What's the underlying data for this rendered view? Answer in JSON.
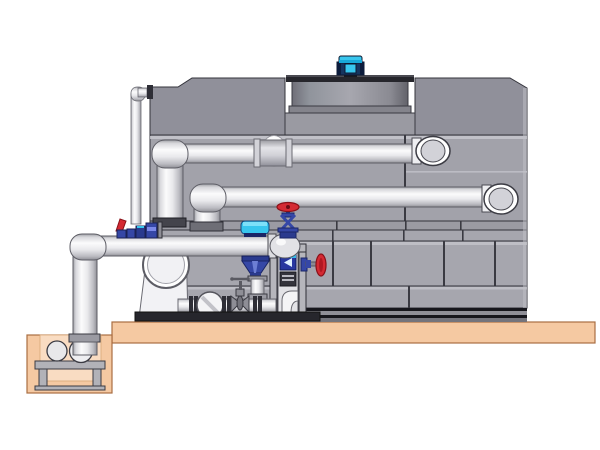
{
  "diagram": {
    "type": "technical-illustration",
    "subject": "Evaporative cooling tower with fan motor, external piping, pump skid and sump pit",
    "components": [
      "cooling-tower-casing",
      "fan-shroud",
      "fan-motor",
      "supply-pipe-upper",
      "return-pipe-middle",
      "header-pipe-lower",
      "makeup-pipe",
      "sump-riser-pipe",
      "sump-pit",
      "sump-pump",
      "pump-stand",
      "circulation-pump",
      "check-valve",
      "gate-valve",
      "control-valve-cyan-actuator",
      "globe-valve-red-handwheel",
      "side-handwheel-valve",
      "lever-valve-red",
      "inline-blue-valve-assembly",
      "instrument-frame-column",
      "flow-indicator",
      "skid-base",
      "concrete-platform"
    ]
  },
  "colors": {
    "platform": "#f5c9a2",
    "platform_edge": "#a96e42",
    "pit_interior": "#f9dcc2",
    "panel": "#a2a2aa",
    "panel_dark": "#90909a",
    "panel_row": "#a6a6ae",
    "panel_thin": "#9b9ba3",
    "panel_light": "#c9c9cf",
    "recess": "#9a9aa2",
    "base_dark": "#16161c",
    "base_gray": "#8f8f97",
    "base_mid": "#74747c",
    "shroud_top": "#26262c",
    "shroud_lip": "#84848c",
    "motor_navy": "#16355f",
    "accent_cyan": "#38c6ee",
    "cyan_dark": "#18a8d8",
    "flange_dark": "#2e2e36",
    "flange_gray": "#9a9aa2",
    "dome": "#d2d2d8",
    "dome_light": "#e2e2e6",
    "ring_white": "#ffffff",
    "valve_navy": "#3547a6",
    "valve_navy_dark": "#2a3a8e",
    "valve_navy_deep": "#1a2566",
    "valve_red": "#d42a33",
    "valve_red_dark": "#8a1018",
    "frame_gray": "#b6b6bc",
    "frame_back": "#e2e2e6",
    "indicator_blue": "#2838a0",
    "dark_box": "#34343c",
    "pump_white": "#f2f2f5",
    "steel": "#8e8e96",
    "stand_gray": "#b2b2b8"
  }
}
